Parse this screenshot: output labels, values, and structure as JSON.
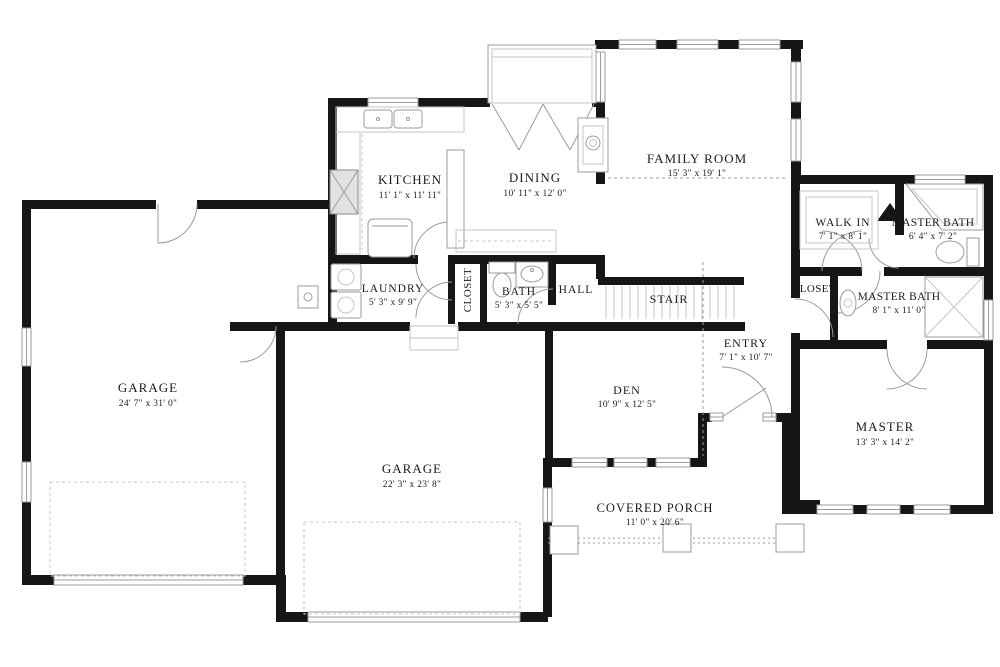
{
  "colors": {
    "wall": "#161616",
    "line": "#9b9b9b",
    "faint": "#c6c6c6",
    "text": "#1c1c1c"
  },
  "rooms": [
    {
      "id": "kitchen",
      "name": "KITCHEN",
      "dims": "11' 1\" x 11' 11\""
    },
    {
      "id": "dining",
      "name": "DINING",
      "dims": "10' 11\" x 12' 0\""
    },
    {
      "id": "family-room",
      "name": "FAMILY ROOM",
      "dims": "15' 3\" x 19' 1\""
    },
    {
      "id": "walk-in",
      "name": "WALK IN",
      "dims": "7' 1\" x 8' 1\""
    },
    {
      "id": "master-bath-upper",
      "name": "MASTER BATH",
      "dims": "6' 4\" x 7' 2\""
    },
    {
      "id": "laundry",
      "name": "LAUNDRY",
      "dims": "5' 3\" x 9' 9\""
    },
    {
      "id": "closet-hall",
      "name": "CLOSET",
      "dims": ""
    },
    {
      "id": "bath",
      "name": "BATH",
      "dims": "5' 3\" x 5' 5\""
    },
    {
      "id": "hall",
      "name": "HALL",
      "dims": ""
    },
    {
      "id": "stair",
      "name": "STAIR",
      "dims": ""
    },
    {
      "id": "closet-entry",
      "name": "CLOSET",
      "dims": ""
    },
    {
      "id": "master-bath-lower",
      "name": "MASTER BATH",
      "dims": "8' 1\" x 11' 0\""
    },
    {
      "id": "entry",
      "name": "ENTRY",
      "dims": "7' 1\" x 10' 7\""
    },
    {
      "id": "den",
      "name": "DEN",
      "dims": "10' 9\" x 12' 5\""
    },
    {
      "id": "garage-main",
      "name": "GARAGE",
      "dims": "24' 7\" x 31' 0\""
    },
    {
      "id": "garage-front",
      "name": "GARAGE",
      "dims": "22' 3\" x 23' 8\""
    },
    {
      "id": "master",
      "name": "MASTER",
      "dims": "13' 3\" x 14' 2\""
    },
    {
      "id": "covered-porch",
      "name": "COVERED PORCH",
      "dims": "11' 0\" x 20' 6\""
    }
  ]
}
